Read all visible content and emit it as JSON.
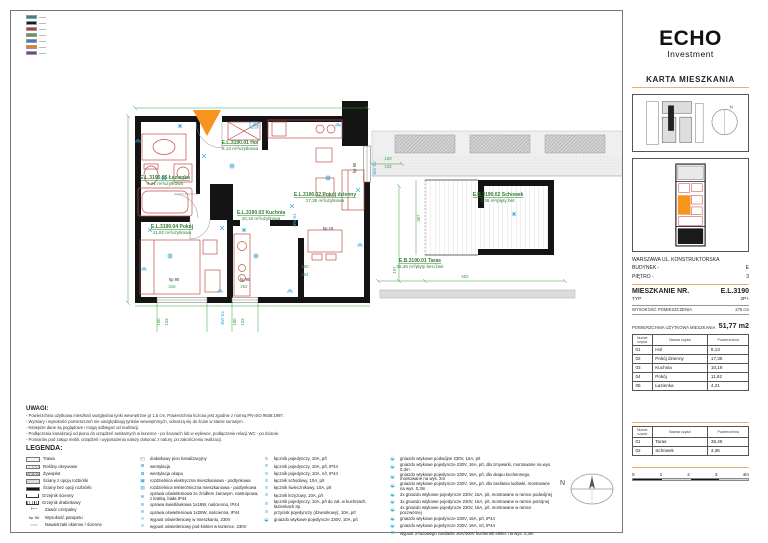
{
  "brand": {
    "name": "ECHO",
    "sub": "Investment"
  },
  "sheet": {
    "title": "KARTA MIESZKANIA"
  },
  "project": {
    "city_line": "WARSZAWA UL. KONSTRUKTORSKA",
    "building_label": "BUDYNEK -",
    "building": "E",
    "floor_label": "PIĘTRO -",
    "floor": "3"
  },
  "apartment": {
    "number_label": "MIESZKANIE NR.",
    "number": "E.L.3190",
    "type_label": "TYP",
    "type": "2P+",
    "height_label": "WYSOKOŚĆ POMIESZCZENIA",
    "height": "275 cm",
    "area_label": "POWIERZCHNIA UŻYTKOWA MIESZKANIA",
    "area": "51,77 m2"
  },
  "tables": {
    "headers": [
      "Numer części",
      "Nazwa części",
      "Powierzchnia"
    ],
    "rooms": [
      [
        "01",
        "Hol",
        "8,13"
      ],
      [
        "02",
        "Pokój dzienny",
        "17,35"
      ],
      [
        "03",
        "Kuchnia",
        "10,16"
      ],
      [
        "04",
        "Pokój",
        "11,92"
      ],
      [
        "05",
        "Łazienka",
        "4,21"
      ]
    ],
    "outdoor": [
      [
        "01",
        "Taras",
        "35,45"
      ],
      [
        "02",
        "Schowek",
        "3,36"
      ]
    ]
  },
  "scalebar": {
    "ticks": [
      "0",
      "1",
      "2",
      "3",
      "4m"
    ]
  },
  "uwagi": {
    "title": "UWAGI:",
    "lines": [
      "- Powierzchnia użytkowa mieszkań uwzględnia tynki wewnętrzne gr 1,5 cm. Powierzchnia liczona jest zgodnie z normą PN-ISO 9836:1997.",
      "- Wymiary i wysokości pomieszczeń nie uwzględniają tynków wewnętrznych, odnoszą się do ścian w stanie surowym.",
      "- Niniejsze dane są poglądowe i mogą odbiegać od realizacji.",
      "- Podłączenia kanalizacji od pionu do urządzeń sanitarnych w łazience - po ścianach lub w wylewce, podłączenie relacji WC - po ścianie.",
      "- Pomiarów pod zakup mebli, urządzeń i wyposażenia należy dokonać z natury, po zakończeniu realizacji."
    ]
  },
  "legend": {
    "title": "LEGENDA:",
    "col1": [
      {
        "sym": "grass-swatch",
        "label": "Trawa"
      },
      {
        "sym": "groundcover-swatch",
        "label": "Rośliny okrywowe"
      },
      {
        "sym": "hedge-swatch",
        "label": "Żywopłot"
      },
      {
        "sym": "wall-removable-swatch",
        "label": "Ściany z opcją rozbiórki"
      },
      {
        "sym": "wall-solid-swatch",
        "label": "Ściany bez opcji rozbiórki"
      },
      {
        "sym": "radiator-wall-icon",
        "label": "Grzejnik ścienny"
      },
      {
        "sym": "radiator-ladder-icon",
        "label": "Grzejnik drabinkowy"
      },
      {
        "sym": "tap-valve-icon",
        "label": "Zawór czerpalny"
      },
      {
        "sym": "sill-height-label",
        "label": "Wysokość parapetu"
      },
      {
        "sym": "window-vent-icon",
        "label": "Nawietrzaki okienne / ścienne"
      }
    ],
    "col2": [
      {
        "sym": "riser-icon",
        "label": "dodatkowy pion kanalizacyjny"
      },
      {
        "sym": "vent-icon",
        "label": "wentylacja"
      },
      {
        "sym": "vent-hood-icon",
        "label": "wentylacja okapu"
      },
      {
        "sym": "re-box-icon",
        "label": "rozdzielnica elektryczna mieszkaniowa - podtynkowa"
      },
      {
        "sym": "rt-box-icon",
        "label": "rozdzielnica teletechniczna mieszkaniowa - podtynkowa"
      },
      {
        "sym": "lamp-ceiling-icon",
        "label": "oprawa oświetleniowa ze źródłem żarowym, nastropowa, z kratką, biała IP44"
      },
      {
        "sym": "lamp-wall18-icon",
        "label": "oprawa świetlówkowa 1x18W, naścienna, IP44"
      },
      {
        "sym": "lamp-wall26-icon",
        "label": "oprawa oświetleniowa 1x26W, naścienna, IP44"
      },
      {
        "sym": "outlet-point-icon",
        "label": "wypust oświetleniowy w mieszkaniu, 230V"
      },
      {
        "sym": "outlet-sconce-icon",
        "label": "wypust oświetleniowy pod kinkiet w łazience, 230V"
      }
    ],
    "col3": [
      {
        "sym": "switch-single-icon",
        "label": "łącznik pojedynczy, 10A, p/t"
      },
      {
        "sym": "switch-single-ip44-icon",
        "label": "łącznik pojedynczy, 10A, p/t, IP44"
      },
      {
        "sym": "switch-single-nt-icon",
        "label": "łącznik pojedynczy, 10A, n/t, IP44"
      },
      {
        "sym": "switch-stair-icon",
        "label": "łącznik schodowy, 10A, p/t"
      },
      {
        "sym": "switch-chandelier-icon",
        "label": "łącznik świecznikowy, 10A, p/t"
      },
      {
        "sym": "switch-cross-icon",
        "label": "łącznik krzyżowy, 10A, p/t"
      },
      {
        "sym": "switch-kitchen-icon",
        "label": "łącznik pojedynczy, 10A, p/t do zał. w kuchniach, łazienkach itp."
      },
      {
        "sym": "button-bell-icon",
        "label": "przycisk pojedynczy (dzwonkowy), 10A, p/t"
      },
      {
        "sym": "socket-single-icon",
        "label": "gniazdo wtykowe pojedyncze 230V, 10A, p/t"
      }
    ],
    "col4": [
      {
        "sym": "socket-double-icon",
        "label": "gniazdo wtykowe podwójne 230V, 16A, p/t"
      },
      {
        "sym": "socket-dishwasher-icon",
        "label": "gniazdo wtykowe pojedyncze 230V, 16A, p/t, dla zmywarki, montowane na wys. 0,3m"
      },
      {
        "sym": "socket-hood-icon",
        "label": "gniazdo wtykowe pojedyncze 230V, 16A, p/t, dla okapu kuchennego, montowane na wys. 2m"
      },
      {
        "sym": "socket-fridge-icon",
        "label": "gniazdo wtykowe pojedyncze 230V, 16A, p/t, dla zasilania lodówki, montowane na wys. 0,3m"
      },
      {
        "sym": "socket-2x-icon",
        "label": "2x gniazdo wtykowe pojedyncze 230V, 16A, p/t, montowane w ramce podwójnej"
      },
      {
        "sym": "socket-3x-icon",
        "label": "3x gniazdo wtykowe pojedyncze 230V, 16A, p/t, montowane w ramce potrójnej"
      },
      {
        "sym": "socket-4x-icon",
        "label": "4x gniazdo wtykowe pojedyncze 230V, 16A, p/t, montowane w ramce poczwórnej"
      },
      {
        "sym": "socket-ip44-icon",
        "label": "gniazdo wtykowe pojedyncze 230V, 16A, p/t, IP44"
      },
      {
        "sym": "socket-nt-ip44-icon",
        "label": "gniazdo wtykowe pojedyncze 230V, 16A, n/t, IP44"
      },
      {
        "sym": "power-3phase-icon",
        "label": "wypust 3-fazowego zasilania 16A/400V kuchenek elektr. na wys. 0,3m"
      }
    ]
  },
  "corner_key": {
    "colors": [
      {
        "c": "#2E8B8B"
      },
      {
        "c": "#1A1A1A"
      },
      {
        "c": "#C0392B"
      },
      {
        "c": "#4AA84F"
      },
      {
        "c": "#3B7DC8"
      },
      {
        "c": "#E67E22"
      },
      {
        "c": "#7D3C98"
      }
    ]
  },
  "plan": {
    "north_label": "N",
    "rooms": [
      {
        "code": "E.L.3190.01",
        "name": "Hol",
        "area": "8,13 m²/użytkowa",
        "x": 120,
        "y": 66
      },
      {
        "code": "E.L.3190.02",
        "name": "Pokój dzienny",
        "area": "17,35 m²/użytkowa",
        "x": 205,
        "y": 118
      },
      {
        "code": "E.L.3190.03",
        "name": "Kuchnia",
        "area": "10,16 m²/użytkowa",
        "x": 141,
        "y": 136
      },
      {
        "code": "E.L.3190.04",
        "name": "Pokój",
        "area": "11,92 m²/użytkowa",
        "x": 52,
        "y": 150
      },
      {
        "code": "E.L.3190.05",
        "name": "Łazienka",
        "area": "4,21 m²/użytkowa",
        "x": 45,
        "y": 101
      },
      {
        "code": "E.B.3190.01",
        "name": "Taras",
        "area": "35,45 m²/płyty bet./żwir",
        "x": 300,
        "y": 184
      },
      {
        "code": "E.B.3190.02",
        "name": "Schowek",
        "area": "3,36 m²/płyty bet.",
        "x": 378,
        "y": 118
      }
    ],
    "dims": [
      {
        "t": "150",
        "x": 40,
        "y": 244,
        "r": -90
      },
      {
        "t": "133",
        "x": 48,
        "y": 244,
        "r": -90
      },
      {
        "t": "100",
        "x": 116,
        "y": 244,
        "r": -90
      },
      {
        "t": "133",
        "x": 124,
        "y": 244,
        "r": -90
      },
      {
        "t": "318",
        "x": 52,
        "y": 210,
        "r": 0
      },
      {
        "t": "252",
        "x": 124,
        "y": 210,
        "r": 0
      },
      {
        "t": "100",
        "x": 185,
        "y": 190,
        "r": 0
      },
      {
        "t": "204",
        "x": 185,
        "y": 198,
        "r": 0
      },
      {
        "t": "552",
        "x": 345,
        "y": 200,
        "r": 0
      },
      {
        "t": "157",
        "x": 276,
        "y": 192,
        "r": -90
      },
      {
        "t": "307",
        "x": 300,
        "y": 140,
        "r": -90
      },
      {
        "t": "100",
        "x": 268,
        "y": 82,
        "r": 0
      },
      {
        "t": "133",
        "x": 268,
        "y": 90,
        "r": 0
      }
    ],
    "hp": [
      {
        "t": "hp 90",
        "x": 54,
        "y": 203,
        "r": 0
      },
      {
        "t": "hp 90",
        "x": 125,
        "y": 203,
        "r": 0
      },
      {
        "t": "hp 19",
        "x": 208,
        "y": 152,
        "r": 0
      },
      {
        "t": "hp 90",
        "x": 236,
        "y": 90,
        "r": -90
      }
    ],
    "window_codes": [
      {
        "t": "BW-01",
        "x": 176,
        "y": 142
      },
      {
        "t": "BW-02",
        "x": 256,
        "y": 90
      },
      {
        "t": "BW-03",
        "x": 104,
        "y": 240
      }
    ],
    "elec": [
      {
        "k": "light",
        "x": 112,
        "y": 88
      },
      {
        "k": "light",
        "x": 50,
        "y": 178
      },
      {
        "k": "light",
        "x": 136,
        "y": 178
      },
      {
        "k": "light",
        "x": 208,
        "y": 100
      },
      {
        "k": "light",
        "x": 44,
        "y": 100
      },
      {
        "k": "switch",
        "x": 84,
        "y": 78
      },
      {
        "k": "switch",
        "x": 102,
        "y": 150
      },
      {
        "k": "switch",
        "x": 172,
        "y": 128
      },
      {
        "k": "switch",
        "x": 30,
        "y": 152
      },
      {
        "k": "switch",
        "x": 238,
        "y": 112
      },
      {
        "k": "socket",
        "x": 24,
        "y": 192
      },
      {
        "k": "socket",
        "x": 100,
        "y": 214
      },
      {
        "k": "socket",
        "x": 170,
        "y": 214
      },
      {
        "k": "socket",
        "x": 240,
        "y": 168
      },
      {
        "k": "socket",
        "x": 135,
        "y": 48
      },
      {
        "k": "socket",
        "x": 218,
        "y": 48
      },
      {
        "k": "socket",
        "x": 18,
        "y": 64
      },
      {
        "k": "vent",
        "x": 394,
        "y": 136
      },
      {
        "k": "vent",
        "x": 60,
        "y": 48
      },
      {
        "k": "vent",
        "x": 124,
        "y": 152
      },
      {
        "k": "box",
        "x": 134,
        "y": 47
      }
    ]
  },
  "colors": {
    "accent": "#F7941E",
    "rule": "#EFAE6E",
    "dim": "#3AA144",
    "roomlabel": "#2E7D32",
    "wall": "#141414",
    "furn": "#C0504D",
    "elec": "#33A3DC"
  }
}
